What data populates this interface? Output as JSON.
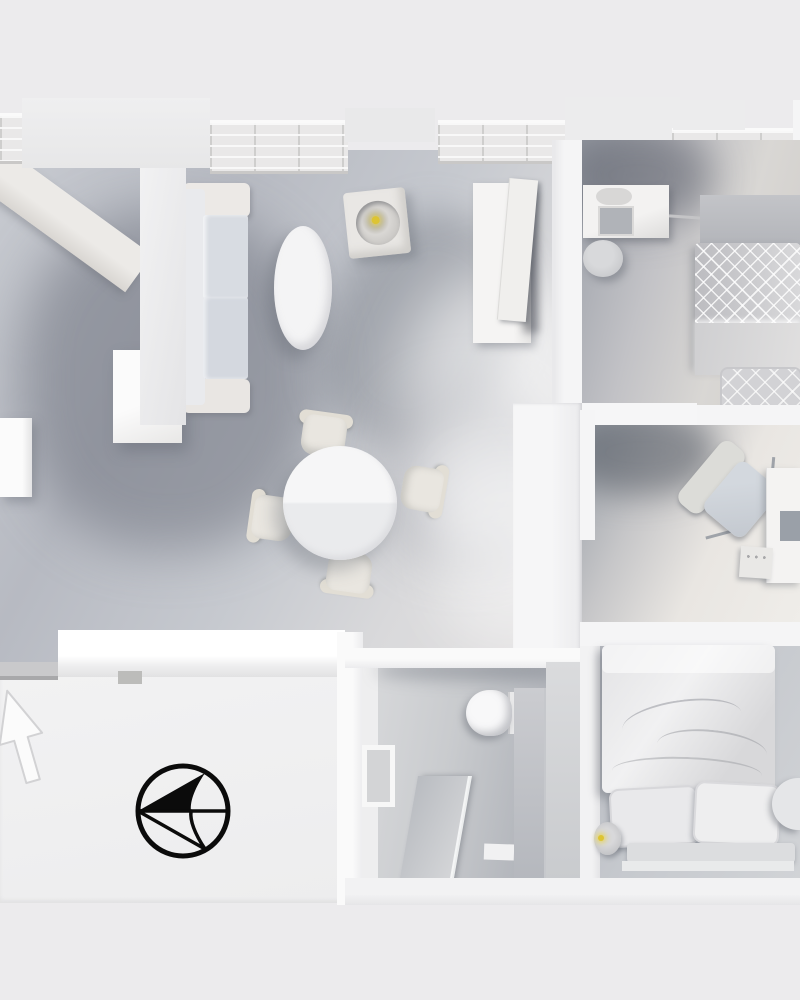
{
  "scene": {
    "type": "3d-floor-plan-top-down-render",
    "label": "Monochrome top-down 3D render of an apartment floor plan",
    "background_color": "#ecebed",
    "wall_color": "#f5f5f6",
    "floor_color": "#c2c6cd",
    "hallway_floor_color": "#f0f0f1",
    "furniture_color": "#f2f2f3",
    "lamp_glow_color": "#ddc433",
    "compass_color": "#0b0b0b"
  },
  "rooms": {
    "living_dining": "Living / dining room",
    "bedroom_top": "Bedroom (top right)",
    "study": "Study nook",
    "bathroom": "Bathroom",
    "bedroom_bottom": "Bedroom (bottom right)",
    "hallway": "Entrance hallway",
    "corridor": "Corridor"
  },
  "furniture": {
    "sofa": "Three-seat sofa",
    "coffee_table": "Oval coffee table",
    "side_table_lamp": "Side table with lit lamp",
    "dining_table": "Round dining table",
    "dining_chair": "Dining chair",
    "wardrobe": "Tall wardrobe with open door",
    "kitchen_unit": "Kitchen / storage unit",
    "window_sill": "Window sill shelf",
    "dresser": "Dresser with mirror",
    "stool": "Stool",
    "bed_quilted": "Double bed with quilted blanket",
    "headboard": "Headboard",
    "office_chair": "Office chair",
    "desk": "Desk with laptop",
    "drawer_unit": "Drawer unit",
    "toilet": "Toilet",
    "shower": "Shower partition",
    "mirror_frame": "Wall mirror / frame",
    "bath_mat": "Bath mat",
    "bed_duvet": "Double bed with duvet and pillows",
    "pillow": "Pillow",
    "bedside_lamp": "Bedside lamp (lit)",
    "nightstand": "Nightstand"
  },
  "icons": {
    "compass": "North orientation compass (pointing left)",
    "entrance_arrow": "Entrance direction arrow (pointing up)"
  },
  "lights": {
    "living_table_lamp": "on",
    "bedroom_bedside_lamp": "on"
  }
}
